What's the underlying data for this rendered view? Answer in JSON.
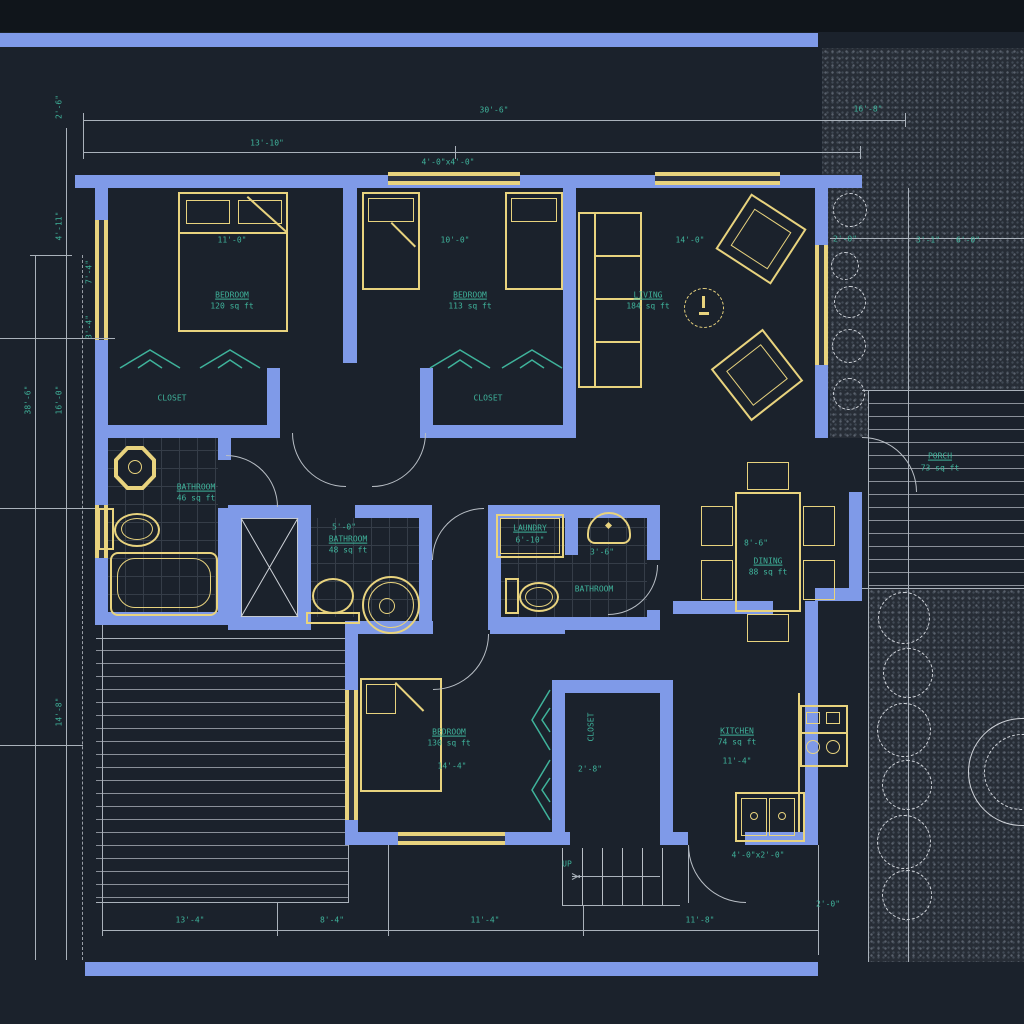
{
  "title": "residential floor plan",
  "colors": {
    "background": "#1b222c",
    "wall": "#7f9ae8",
    "window_fixture": "#e8d37e",
    "text": "#3fb39b",
    "line": "#aab2bb"
  },
  "rooms": {
    "bedroom1": {
      "name": "BEDROOM",
      "area": "120 sq ft",
      "width": "11'-0\""
    },
    "bedroom2": {
      "name": "BEDROOM",
      "area": "113 sq ft",
      "width": "10'-0\""
    },
    "living": {
      "name": "LIVING",
      "area": "184 sq ft",
      "width": "14'-0\""
    },
    "closet1": {
      "name": "CLOSET"
    },
    "closet2": {
      "name": "CLOSET"
    },
    "closet3": {
      "name": "CLOSET",
      "width": "2'-8\""
    },
    "bathroom1": {
      "name": "BATHROOM",
      "area": "46 sq ft"
    },
    "bathroom2": {
      "name": "BATHROOM",
      "area": "48 sq ft",
      "width": "5'-0\""
    },
    "laundry": {
      "name": "LAUNDRY",
      "width": "6'-10\""
    },
    "halfbath": {
      "name": "BATHROOM",
      "sink_width": "3'-6\""
    },
    "dining": {
      "name": "DINING",
      "area": "88 sq ft",
      "width": "8'-6\""
    },
    "kitchen": {
      "name": "KITCHEN",
      "area": "74 sq ft",
      "width": "11'-4\"",
      "sink": "4'-0\"x2'-0\""
    },
    "bedroom3": {
      "name": "BEDROOM",
      "area": "130 sq ft",
      "width": "14'-4\""
    },
    "porch": {
      "name": "PORCH",
      "area": "73 sq ft"
    },
    "stairs": {
      "label": "UP"
    }
  },
  "dimensions": {
    "top_overall": "30'-6\"",
    "top_left": "13'-10\"",
    "top_right": "16'-8\"",
    "top_window": "4'-0\"x4'-0\"",
    "right_a": "2'-0\"",
    "right_b": "3'-1\"",
    "right_c": "6'-0\"",
    "left_a": "2'-6\"",
    "left_b": "4'-11\"",
    "left_overall": "38'-6\"",
    "left_c": "16'-0\"",
    "left_d": "14'-8\"",
    "left_window": "7'-4\"",
    "left_window2": "3'-4\"",
    "bottom_a": "13'-4\"",
    "bottom_b": "8'-4\"",
    "bottom_c": "11'-4\"",
    "bottom_d": "11'-8\"",
    "bottom_e": "2'-0\""
  }
}
